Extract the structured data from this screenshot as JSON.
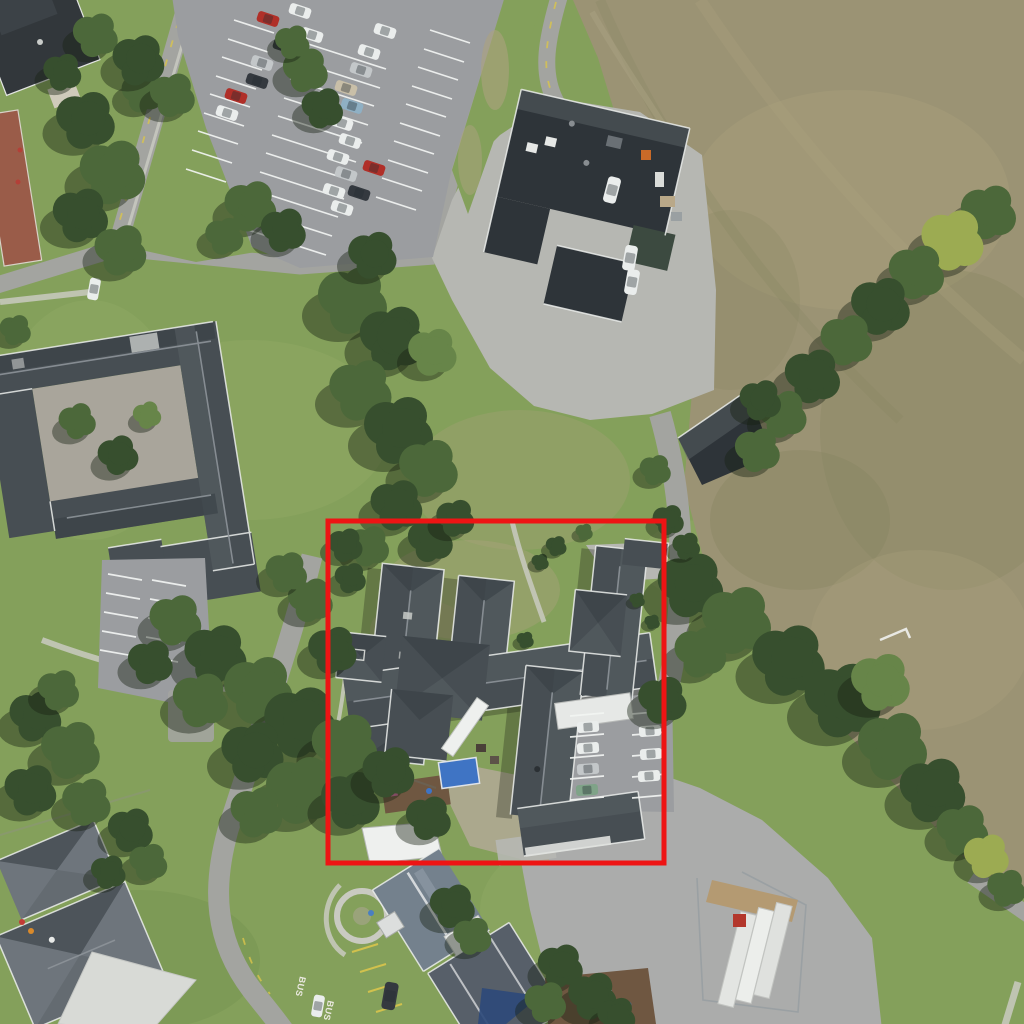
{
  "meta": {
    "title": "Aerial orthophoto of a school campus with one building complex highlighted",
    "type": "aerial-photograph",
    "image_width": 1024,
    "image_height": 1024
  },
  "annotation": {
    "shape": "rectangle",
    "color": "#ee1414",
    "stroke_width": 5,
    "box": {
      "x": 328,
      "y": 521,
      "width": 336,
      "height": 342
    }
  },
  "road_markings": {
    "bus": "BUS"
  },
  "scene": {
    "regions": [
      "dry-grass-field",
      "main-parking-lot",
      "access-roads",
      "courtyard-building",
      "service-building",
      "storage-shed",
      "highlighted-building-complex",
      "kindergarten-buildings",
      "residential-houses",
      "tree-belts",
      "playground",
      "construction-yard",
      "bus-bay"
    ]
  },
  "palette": {
    "grass": "#84a05b",
    "grass-light": "#99b16c",
    "grass-dark": "#648044",
    "field": "#9b9374",
    "field-light": "#aba27f",
    "field-dark": "#85855e",
    "road": "#a3a4a0",
    "road-light": "#b6b7b2",
    "road-dark": "#6f7368",
    "parking-asphalt": "#9b9da0",
    "yard": "#b1b2ae",
    "courtyard": "#abacab",
    "roof-dark": "#474e53",
    "roof-deep": "#2e3439",
    "roof-facet-dark": "#394046",
    "roof-facet-light": "#5a6166",
    "roof-mid": "#6e757c",
    "roof-light": "#d8dad6",
    "roof-blue": "#74818d",
    "roof-blue2": "#575f69",
    "ridge": "#8d9499",
    "eave": "#eceeec",
    "path-pale": "#c9cac1",
    "tree-dark": "#374f2e",
    "tree-mid": "#4c683a",
    "tree-light": "#678549",
    "tree-yellow": "#9cab52",
    "brick": "#9a5c49",
    "tarp-blue": "#3f74c4",
    "sail-blue": "#2e4a7a",
    "dirt": "#b49a72",
    "bark": "#6f5741",
    "car-white": "#eaedec",
    "car-silver": "#c3c7c9",
    "car-red": "#b02f28",
    "car-dark": "#34393f",
    "car-teal": "#7fa388",
    "car-blue": "#8fb0c4",
    "car-beige": "#c9bfa8",
    "yellow": "#d9c44b",
    "annotation": "#ee1414"
  }
}
